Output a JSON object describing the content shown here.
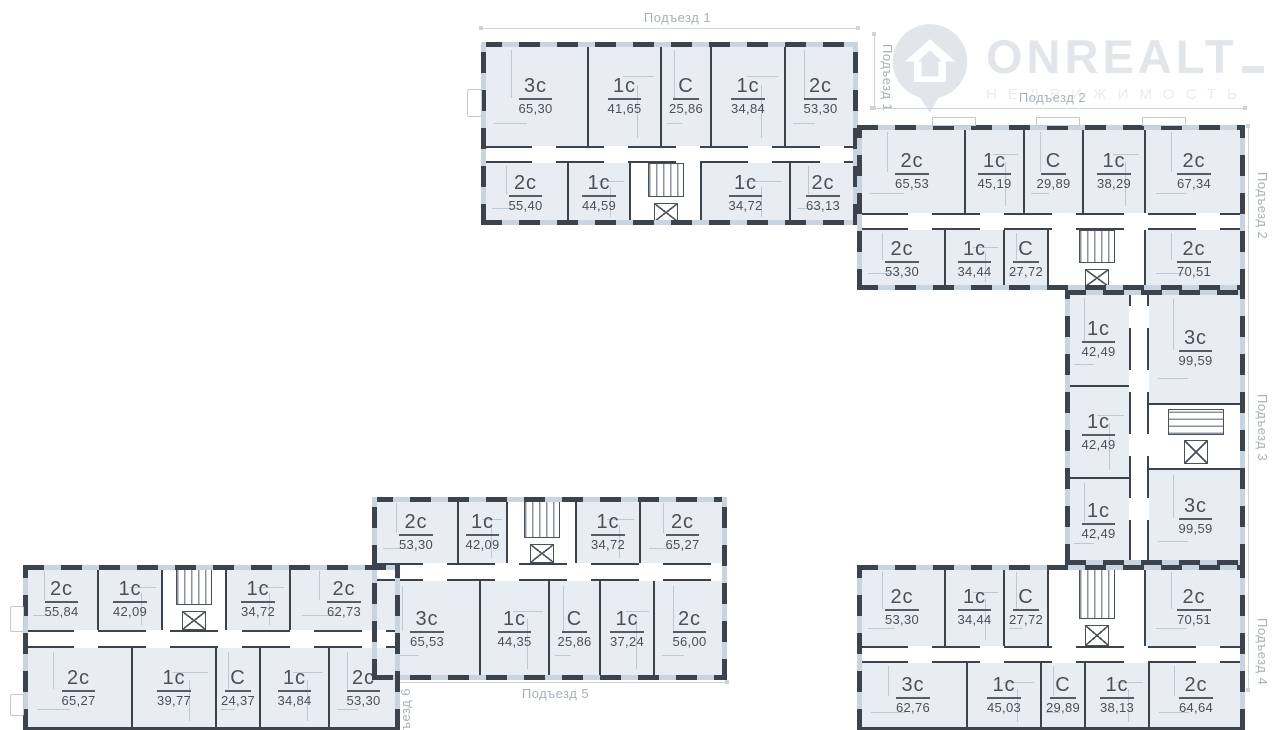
{
  "watermark": {
    "brand": "ONREALT",
    "subtitle": "НЕДВИЖИМОСТЬ",
    "icon": "house-pin-icon",
    "color": "#e2e6eb"
  },
  "entrances": {
    "e1_top": "Подъезд 1",
    "e1_side": "Подъезд 1",
    "e2_top": "Подъезд 2",
    "e2_side": "Подъезд 2",
    "e3_side": "Подъезд 3",
    "e4_side": "Подъезд 4",
    "e5_bottom": "Подъезд 5",
    "e6_side": "Подъезд 6"
  },
  "legend": {
    "wall_color": "#3c434c",
    "room_fill": "#e8ecf3",
    "partition_color": "#bcc8d6",
    "dimension_color": "#cfd4da",
    "text_color": "#4b5058",
    "muted_color": "#a9b1bb"
  },
  "buildings": {
    "b1": {
      "name": "Подъезд 1",
      "rows": [
        {
          "cells": [
            {
              "t": "3с",
              "a": "65,30"
            },
            {
              "t": "1с",
              "a": "41,65"
            },
            {
              "t": "С",
              "a": "25,86"
            },
            {
              "t": "1с",
              "a": "34,84"
            },
            {
              "t": "2с",
              "a": "53,30"
            }
          ]
        },
        {
          "cells": [
            {
              "t": "2с",
              "a": "55,40"
            },
            {
              "t": "1с",
              "a": "44,59"
            },
            {
              "core": true
            },
            {
              "t": "1с",
              "a": "34,72"
            },
            {
              "t": "2с",
              "a": "63,13"
            }
          ]
        }
      ]
    },
    "b2": {
      "name": "Подъезд 2",
      "rows": [
        {
          "cells": [
            {
              "t": "2с",
              "a": "65,53"
            },
            {
              "t": "1с",
              "a": "45,19"
            },
            {
              "t": "С",
              "a": "29,89"
            },
            {
              "t": "1с",
              "a": "38,29"
            },
            {
              "t": "2с",
              "a": "67,34"
            }
          ]
        },
        {
          "cells": [
            {
              "t": "2с",
              "a": "53,30"
            },
            {
              "t": "1с",
              "a": "34,44"
            },
            {
              "t": "С",
              "a": "27,72"
            },
            {
              "core": true
            },
            {
              "t": "2с",
              "a": "70,51"
            }
          ]
        }
      ]
    },
    "b3": {
      "name": "Подъезд 3",
      "cols": [
        {
          "cells": [
            {
              "t": "1с",
              "a": "42,49"
            },
            {
              "t": "1с",
              "a": "42,49"
            },
            {
              "t": "1с",
              "a": "42,49"
            }
          ]
        },
        {
          "cells": [
            {
              "t": "3с",
              "a": "99,59"
            },
            {
              "core": true
            },
            {
              "t": "3с",
              "a": "99,59"
            }
          ]
        }
      ]
    },
    "b4": {
      "name": "Подъезд 4",
      "rows": [
        {
          "cells": [
            {
              "t": "2с",
              "a": "53,30"
            },
            {
              "t": "1с",
              "a": "34,44"
            },
            {
              "t": "С",
              "a": "27,72"
            },
            {
              "core": true
            },
            {
              "t": "2с",
              "a": "70,51"
            }
          ]
        },
        {
          "cells": [
            {
              "t": "3с",
              "a": "62,76"
            },
            {
              "t": "1с",
              "a": "45,03"
            },
            {
              "t": "С",
              "a": "29,89"
            },
            {
              "t": "1с",
              "a": "38,13"
            },
            {
              "t": "2с",
              "a": "64,64"
            }
          ]
        }
      ]
    },
    "b5": {
      "name": "Подъезд 5",
      "rows": [
        {
          "cells": [
            {
              "t": "2с",
              "a": "53,30"
            },
            {
              "t": "1с",
              "a": "42,09"
            },
            {
              "core": true
            },
            {
              "t": "1с",
              "a": "34,72"
            },
            {
              "t": "2с",
              "a": "65,27"
            }
          ]
        },
        {
          "cells": [
            {
              "t": "3с",
              "a": "65,53"
            },
            {
              "t": "1с",
              "a": "44,35"
            },
            {
              "t": "С",
              "a": "25,86"
            },
            {
              "t": "1с",
              "a": "37,24"
            },
            {
              "t": "2с",
              "a": "56,00"
            }
          ]
        }
      ]
    },
    "b6": {
      "name": "Подъезд 6",
      "rows": [
        {
          "cells": [
            {
              "t": "2с",
              "a": "55,84"
            },
            {
              "t": "1с",
              "a": "42,09"
            },
            {
              "core": true
            },
            {
              "t": "1с",
              "a": "34,72"
            },
            {
              "t": "2с",
              "a": "62,73"
            }
          ]
        },
        {
          "cells": [
            {
              "t": "2с",
              "a": "65,27"
            },
            {
              "t": "1с",
              "a": "39,77"
            },
            {
              "t": "С",
              "a": "24,37"
            },
            {
              "t": "1с",
              "a": "34,84"
            },
            {
              "t": "2с",
              "a": "53,30"
            }
          ]
        }
      ]
    }
  }
}
